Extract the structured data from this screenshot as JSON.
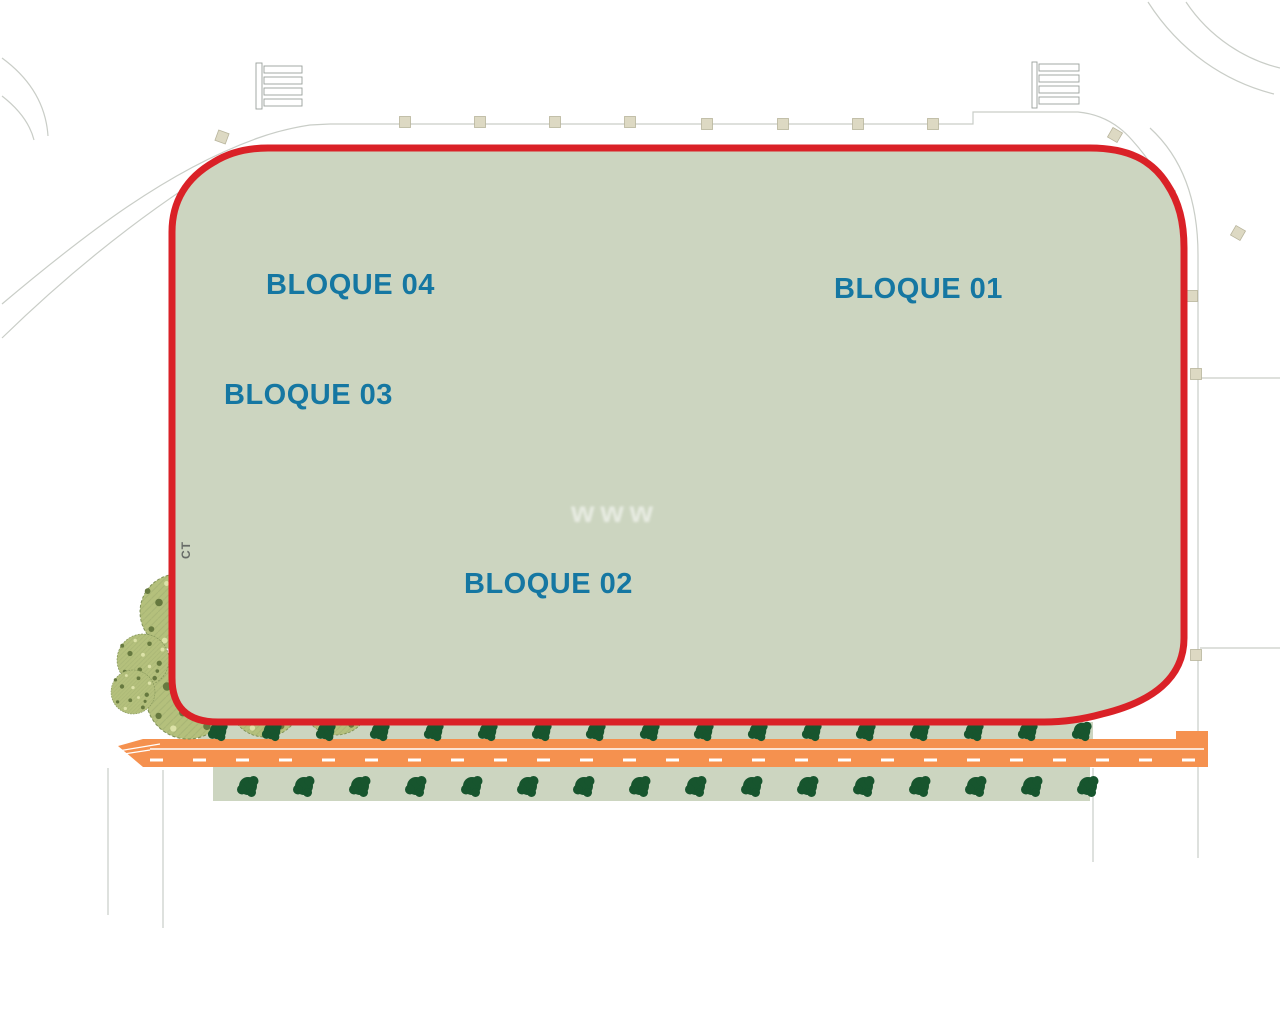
{
  "labels": {
    "blocks": [
      {
        "id": "bloque-04",
        "label": "BLOQUE 04"
      },
      {
        "id": "bloque-03",
        "label": "BLOQUE 03"
      },
      {
        "id": "bloque-02",
        "label": "BLOQUE 02"
      },
      {
        "id": "bloque-01",
        "label": "BLOQUE 01"
      }
    ],
    "ct": "CT",
    "watermark": "www"
  },
  "colors": {
    "boundary_red": "#da2127",
    "label_blue": "#1577a2",
    "sage": "#ccd5c0",
    "white_path": "#f7f8f4",
    "pool": "#b9e5ea",
    "pool_border": "#86c3cb",
    "pool_deep": "#a5dde8",
    "pool_deep_border": "#3f98a8",
    "road_orange": "#f5914f",
    "beige": "#ddd9c3",
    "beige_border": "#b8b49c",
    "tree_dark": "#17552e",
    "tree_medium": "#4f8f5c",
    "palm_green": "#1d9146",
    "palm_dark": "#156b38",
    "mottled_base": "#b4c07c",
    "mottled_dot_dark": "#66793f",
    "mottled_dot_light": "#dce2a8",
    "outline_gray": "#9aa09c",
    "faint_line": "#c9cdc7",
    "hatch_gray": "#b9bfba",
    "ct_gray": "#666b67",
    "watermark_white": "#ffffff"
  }
}
